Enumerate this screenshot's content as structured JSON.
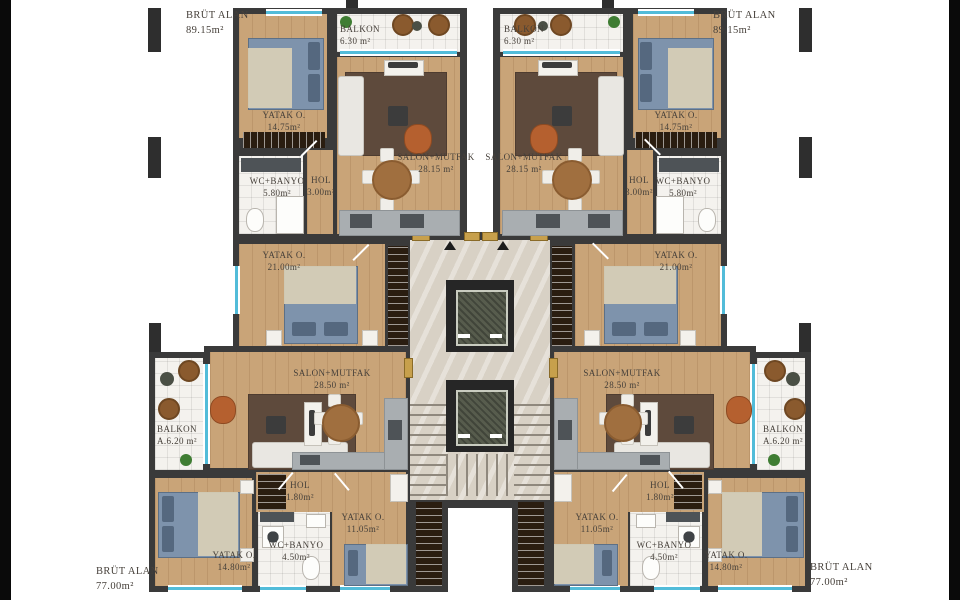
{
  "page": {
    "background": "#ffffff"
  },
  "colors": {
    "wall": "#3a3a3a",
    "wood_floor": "#c9a478",
    "tile_floor": "#f4f2ee",
    "marble_floor": "#d8d1c5",
    "window_accent": "#52bcd9",
    "rug": "#5e4a3c",
    "bed": "#7e93ac",
    "armchair": "#b5602f",
    "kitchen_counter": "#a9aeb1",
    "label_text": "#46403a"
  },
  "units": {
    "top_left": {
      "gross": {
        "label": "BRÜT ALAN",
        "area": "89.15m²"
      },
      "rooms": {
        "bedroom": {
          "name": "YATAK O.",
          "area": "14.75m²"
        },
        "balcony": {
          "name": "BALKON",
          "area": "6.30 m²"
        },
        "living": {
          "name": "SALON+MUTFAK",
          "area": "28.15 m²"
        },
        "bath": {
          "name": "WC+BANYO",
          "area": "5.80m²"
        },
        "hall": {
          "name": "HOL",
          "area": "3.00m²"
        },
        "bedroom2": {
          "name": "YATAK O.",
          "area": "21.00m²"
        }
      }
    },
    "top_right": {
      "gross": {
        "label": "BRÜT ALAN",
        "area": "89.15m²"
      },
      "rooms": {
        "bedroom": {
          "name": "YATAK O.",
          "area": "14.75m²"
        },
        "balcony": {
          "name": "BALKON",
          "area": "6.30 m²"
        },
        "living": {
          "name": "SALON+MUTFAK",
          "area": "28.15 m²"
        },
        "bath": {
          "name": "WC+BANYO",
          "area": "5.80m²"
        },
        "hall": {
          "name": "HOL",
          "area": "3.00m²"
        },
        "bedroom2": {
          "name": "YATAK O.",
          "area": "21.00m²"
        }
      }
    },
    "bottom_left": {
      "gross": {
        "label": "BRÜT ALAN",
        "area": "77.00m²"
      },
      "rooms": {
        "balcony": {
          "name": "BALKON",
          "area": "A.6.20 m²"
        },
        "living": {
          "name": "SALON+MUTFAK",
          "area": "28.50 m²"
        },
        "hall": {
          "name": "HOL",
          "area": "1.80m²"
        },
        "bedroom_small": {
          "name": "YATAK O.",
          "area": "11.05m²"
        },
        "bath": {
          "name": "WC+BANYO",
          "area": "4.50m²"
        },
        "bedroom_large": {
          "name": "YATAK O.",
          "area": "14.80m²"
        }
      }
    },
    "bottom_right": {
      "gross": {
        "label": "BRÜT ALAN",
        "area": "77.00m²"
      },
      "rooms": {
        "balcony": {
          "name": "BALKON",
          "area": "A.6.20 m²"
        },
        "living": {
          "name": "SALON+MUTFAK",
          "area": "28.50 m²"
        },
        "hall": {
          "name": "HOL",
          "area": "1.80m²"
        },
        "bedroom_small": {
          "name": "YATAK O.",
          "area": "11.05m²"
        },
        "bath": {
          "name": "WC+BANYO",
          "area": "4.50m²"
        },
        "bedroom_large": {
          "name": "YATAK O.",
          "area": "14.80m²"
        }
      }
    }
  }
}
